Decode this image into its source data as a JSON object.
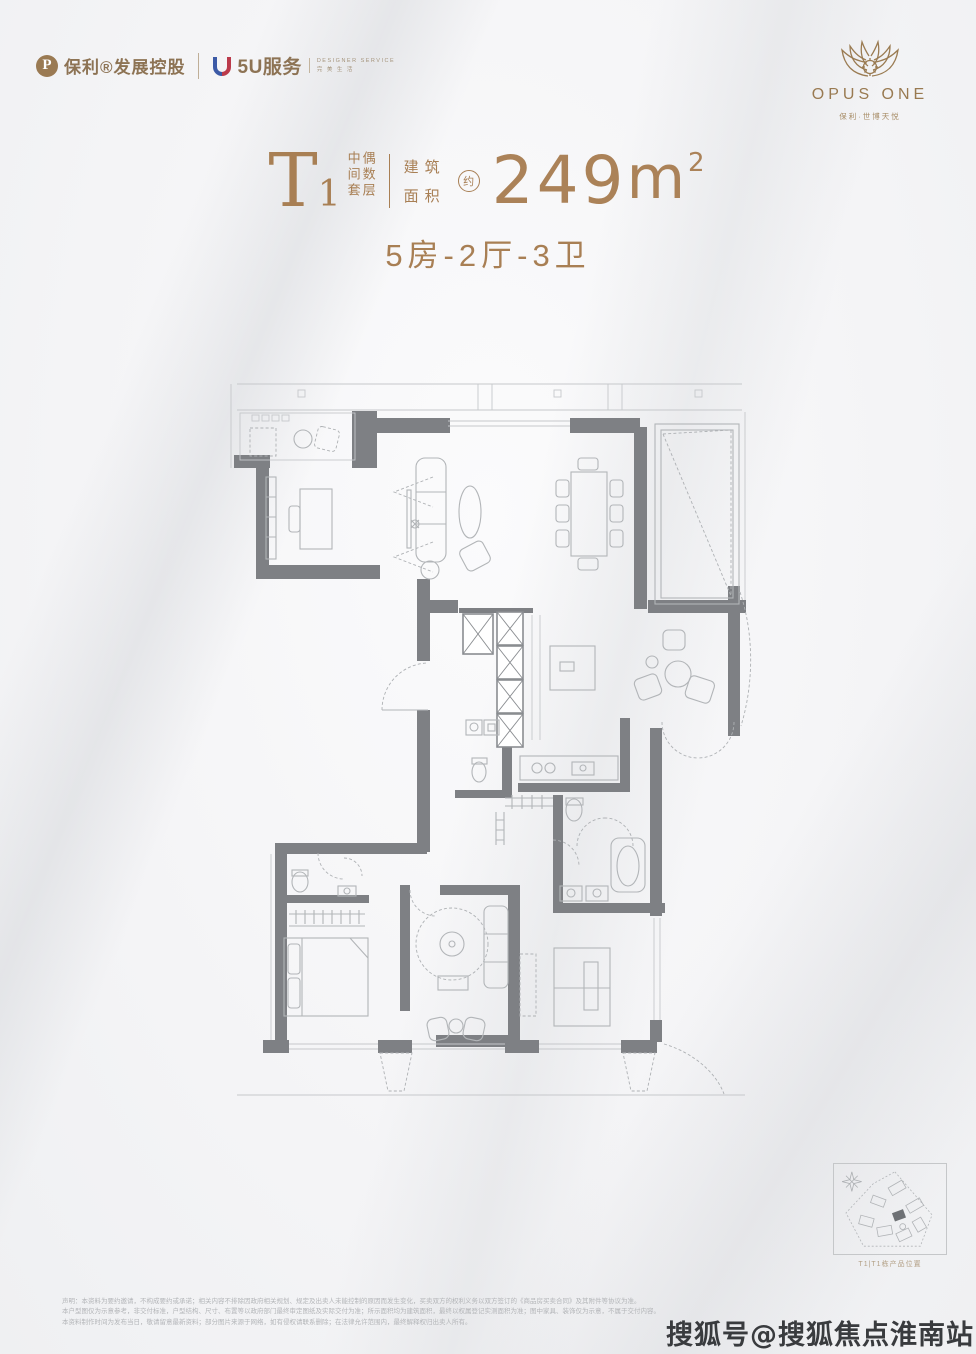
{
  "header": {
    "left_brand": {
      "poly_icon_letter": "P",
      "poly_name": "保利®发展控股",
      "service_name": "5U服务",
      "service_tagline_line1": "DESIGNER SERVICE",
      "service_tagline_line2": "完 美 生 活"
    },
    "right_brand": {
      "wordmark": "OPUS ONE",
      "subtitle": "保利·世博天悦"
    }
  },
  "title": {
    "unit_letter": "T",
    "unit_number": "1",
    "unit_note_col1": "中间套",
    "unit_note_col2": "偶数层",
    "area_label_line1": "建筑",
    "area_label_line2": "面积",
    "approx_badge": "约",
    "area_value": "249",
    "area_unit": "m",
    "area_sup": "2",
    "layout_summary": "5房-2厅-3卫"
  },
  "floorplan": {
    "description": "T1户型平面图（5房2厅3卫，约249平方米）"
  },
  "siteplan": {
    "caption": "T1|T1栋产品位置"
  },
  "disclaimer": {
    "lines": [
      "声明：本资料为要约邀请，不构成要约或承诺；相关内容不排除因政府相关规划、规定及出卖人未能控制的原因而发生变化，买卖双方的权利义务以双方签订的《商品房买卖合同》及其附件等协议为准。",
      "本户型图仅为示意参考，非交付标准，户型结构、尺寸、布置等以政府部门最终审定图纸及实际交付为准；所示面积均为建筑面积，最终以权属登记实测面积为准；图中家具、装饰仅为示意，不属于交付内容。",
      "本资料制作时间为发布当日，敬请留意最新资料；部分图片来源于网络，如有侵权请联系删除；在法律允许范围内，最终解释权归出卖人所有。"
    ]
  },
  "watermark": {
    "text": "搜狐号@搜狐焦点淮南站"
  },
  "colors": {
    "gold": "#a87f54",
    "wall_gray": "#7e8084",
    "furniture_gray": "#b2b5b8",
    "watermark_dark": "#393b3e",
    "background": "#f4f4f6"
  }
}
